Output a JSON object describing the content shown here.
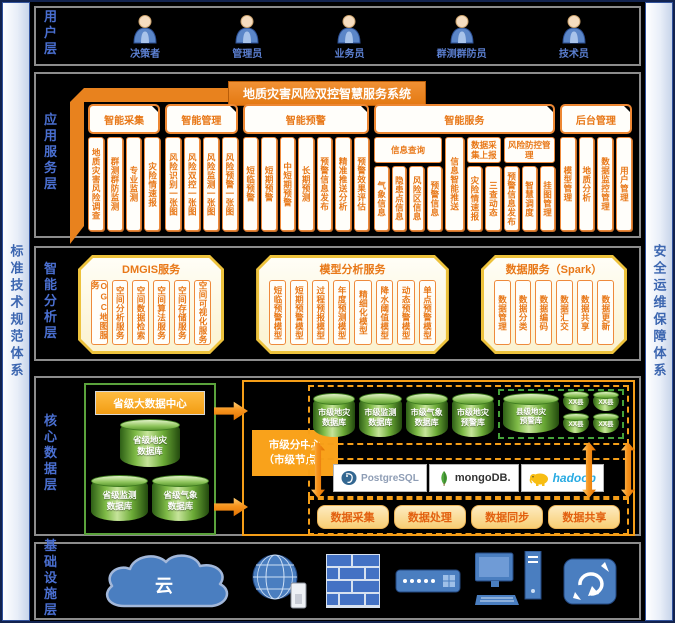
{
  "frame": {
    "left_bar": "标准技术规范体系",
    "right_bar": "安全运维保障体系"
  },
  "user_layer": {
    "label": "用户层",
    "users": [
      "决策者",
      "管理员",
      "业务员",
      "群测群防员",
      "技术员"
    ]
  },
  "app_layer": {
    "label": "应用服务层",
    "title": "地质灾害风险双控智慧服务系统",
    "groups": [
      {
        "label": "智能采集",
        "items": [
          "地质灾害风险调查",
          "群测群防监测",
          "专业监测",
          "灾险情速报"
        ]
      },
      {
        "label": "智能管理",
        "items": [
          "风险识别一张图",
          "风险双控一张图",
          "风险监测一张图",
          "风险预警一张图"
        ]
      },
      {
        "label": "智能预警",
        "items": [
          "短临预警",
          "短期预警",
          "中短期预警",
          "长期预测",
          "预警信息发布",
          "精准推送分析",
          "预警效果评估"
        ]
      },
      {
        "label": "智能服务",
        "subgroups": [
          {
            "header": "信息查询",
            "items": [
              "气象信息",
              "隐患点信息",
              "风险区信息",
              "预警信息"
            ]
          },
          {
            "tall": "信息智能推送"
          },
          {
            "header": "数据采集上报",
            "items": [
              "灾险情速报",
              "三查动态"
            ]
          },
          {
            "header": "风险防控管理",
            "items": [
              "预警信息发布",
              "智慧调度",
              "挂图管理"
            ]
          }
        ]
      },
      {
        "label": "后台管理",
        "items": [
          "模型管理",
          "地质分析",
          "数据监控管理",
          "用户管理"
        ]
      }
    ]
  },
  "analysis_layer": {
    "label": "智能分析层",
    "boxes": [
      {
        "title": "DMGIS服务",
        "items": [
          "OGC地图服务",
          "空间分析服务",
          "空间数据检索",
          "空间算法服务",
          "空间存储服务",
          "空间可视化服务"
        ]
      },
      {
        "title": "模型分析服务",
        "items": [
          "短临预警模型",
          "短期预警模型",
          "过程预报模型",
          "年度预测模型",
          "精细化模型",
          "降水阈值模型",
          "动态预警模型",
          "单点预警模型"
        ]
      },
      {
        "title": "数据服务（Spark）",
        "items": [
          "数据管理",
          "数据分类",
          "数据编码",
          "数据汇交",
          "数据共享",
          "数据更新"
        ]
      }
    ]
  },
  "data_layer": {
    "label": "核心数据层",
    "province": {
      "title": "省级大数据中心",
      "dbs": [
        {
          "l1": "省级地灾",
          "l2": "数据库"
        },
        {
          "l1": "省级监测",
          "l2": "数据库"
        },
        {
          "l1": "省级气象",
          "l2": "数据库"
        }
      ]
    },
    "city": {
      "label_l1": "市级分中心",
      "label_l2": "（市级节点）",
      "dbs": [
        {
          "l1": "市级地灾",
          "l2": "数据库"
        },
        {
          "l1": "市级监测",
          "l2": "数据库"
        },
        {
          "l1": "市级气象",
          "l2": "数据库"
        },
        {
          "l1": "市级地灾",
          "l2": "预警库"
        }
      ],
      "county_db": {
        "l1": "县级地灾",
        "l2": "预警库"
      },
      "small_dbs": [
        "XX县",
        "XX县",
        "XX县",
        "XX县"
      ],
      "engines": [
        {
          "name": "PostgreSQL"
        },
        {
          "name": "mongoDB."
        },
        {
          "name": "hadoop"
        }
      ],
      "functions": [
        "数据采集",
        "数据处理",
        "数据同步",
        "数据共享"
      ]
    }
  },
  "infra_layer": {
    "label": "基础设施层",
    "cloud_label": "云",
    "icons": [
      "cloud",
      "internet-globe",
      "firewall",
      "network-switch",
      "workstation",
      "router"
    ]
  }
}
